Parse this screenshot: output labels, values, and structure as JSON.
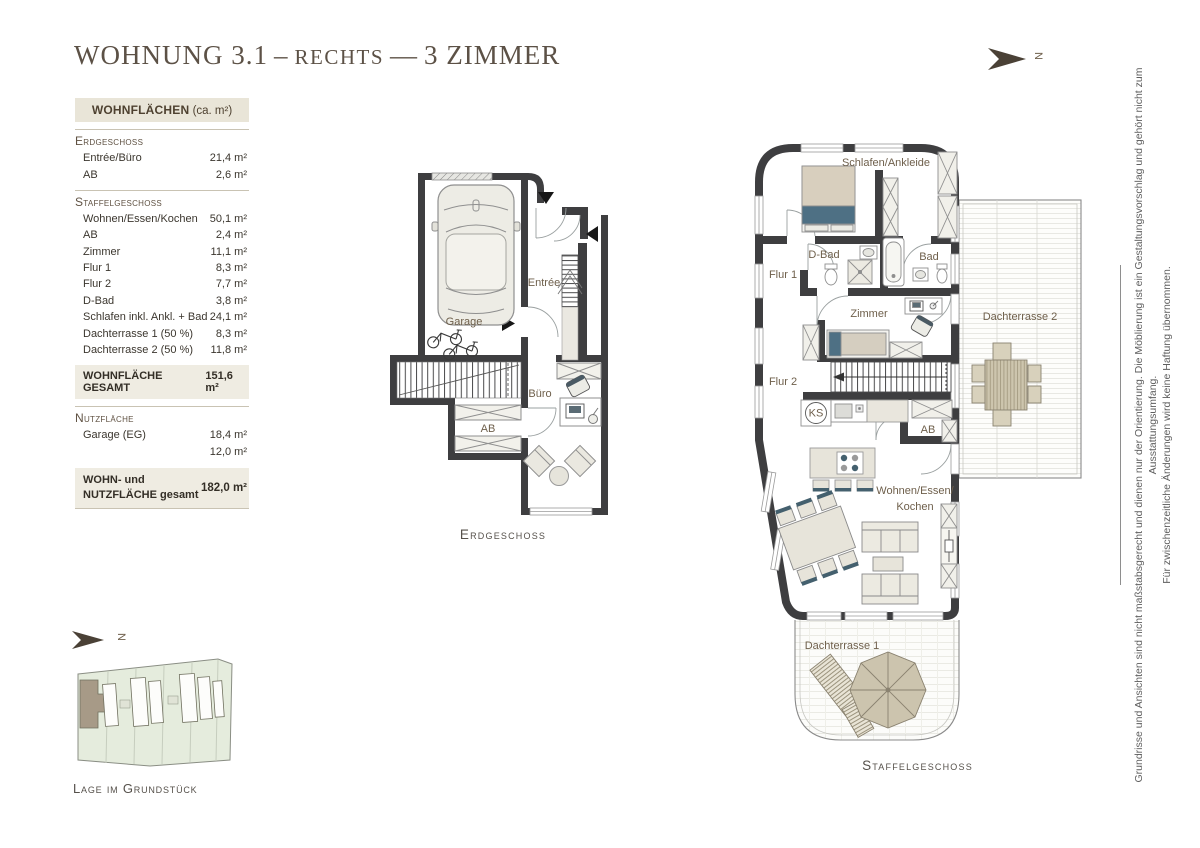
{
  "page": {
    "title": {
      "part1": "WOHNUNG 3.1",
      "dash1": "–",
      "part2": "RECHTS",
      "dash2": "—",
      "part3": "3 ZIMMER"
    },
    "north_letter": "N"
  },
  "area_table": {
    "header": {
      "bold": "WOHNFLÄCHEN",
      "unit": "(ca. m²)"
    },
    "sections": [
      {
        "title": "Erdgeschoss",
        "rows": [
          {
            "label": "Entrée/Büro",
            "value": "21,4 m²"
          },
          {
            "label": "AB",
            "value": "2,6 m²"
          }
        ]
      },
      {
        "title": "Staffelgeschoss",
        "rows": [
          {
            "label": "Wohnen/Essen/Kochen",
            "value": "50,1 m²"
          },
          {
            "label": "AB",
            "value": "2,4 m²"
          },
          {
            "label": "Zimmer",
            "value": "11,1 m²"
          },
          {
            "label": "Flur 1",
            "value": "8,3 m²"
          },
          {
            "label": "Flur 2",
            "value": "7,7 m²"
          },
          {
            "label": "D-Bad",
            "value": "3,8 m²"
          },
          {
            "label": "Schlafen inkl. Ankl. + Bad",
            "value": "24,1 m²"
          },
          {
            "label": "Dachterrasse 1 (50 %)",
            "value": "8,3 m²"
          },
          {
            "label": "Dachterrasse 2 (50 %)",
            "value": "11,8 m²"
          }
        ]
      }
    ],
    "total_living": {
      "label": "WOHNFLÄCHE GESAMT",
      "value": "151,6 m²"
    },
    "utility_section": {
      "title": "Nutzfläche",
      "rows": [
        {
          "label": "Garage (EG)",
          "value": "18,4 m²"
        },
        {
          "label": "HWR (KG)",
          "value": "12,0 m²"
        }
      ]
    },
    "total_overall": {
      "label_line1": "WOHN- und",
      "label_line2": "NUTZFLÄCHE gesamt",
      "value": "182,0 m²"
    }
  },
  "floorplans": {
    "erdgeschoss": {
      "caption": "Erdgeschoss",
      "labels": {
        "garage": "Garage",
        "entree": "Entrée",
        "buero": "Büro",
        "ab": "AB"
      }
    },
    "staffelgeschoss": {
      "caption": "Staffelgeschoss",
      "labels": {
        "schlafen_ankleide": "Schlafen/Ankleide",
        "d_bad": "D-Bad",
        "bad": "Bad",
        "flur1": "Flur 1",
        "zimmer": "Zimmer",
        "flur2": "Flur 2",
        "ks": "KS",
        "ab": "AB",
        "wohnen1": "Wohnen/Essen/",
        "wohnen2": "Kochen",
        "dachterrasse1": "Dachterrasse 1",
        "dachterrasse2": "Dachterrasse 2"
      }
    }
  },
  "site_plan": {
    "caption": "Lage im Grundstück",
    "north_letter": "N"
  },
  "disclaimer": {
    "line1": "Grundrisse und Ansichten sind nicht maßstabsgerecht und dienen nur der Orientierung. Die Möblierung ist ein Gestaltungsvorschlag und gehört nicht zum Ausstattungsumfang.",
    "line2": "Für zwischenzeitliche Änderungen wird keine Haftung übernommen."
  },
  "colors": {
    "wall": "#3e3e40",
    "accent_brown": "#6e5f4b",
    "table_header_bg": "#e9e5d8",
    "total_bg": "#efece2",
    "bed_blue": "#4e7084",
    "wood": "#cdc5ae",
    "site_green": "#e5ecdd",
    "highlight_building": "#a79a87"
  }
}
